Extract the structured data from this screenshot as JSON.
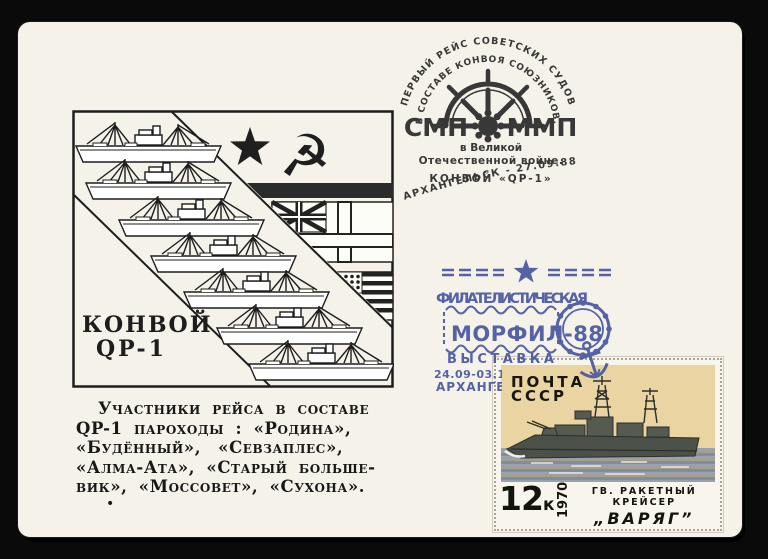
{
  "colors": {
    "background": "#0a0a0a",
    "paper": "#f5f2e9",
    "ink_black": "#2b2b2b",
    "ink_blue": "#44549f",
    "stamp_cream": "#e9d4a2",
    "stamp_sea": "#97a0ab",
    "warship_grey": "#4b5049"
  },
  "cachet": {
    "box_label_line1": "КОНВОЙ",
    "box_label_line2": "QP-1"
  },
  "note": {
    "lines": [
      "Участники рейса в составе",
      "QP-1 пароходы : «Родина»,",
      "«Будённый», «Севзаплес»,",
      "«Алма-Ата», «Старый больше-",
      "вик», «Моссовет», «Сухона»."
    ],
    "bullet": "•"
  },
  "postmark_voyage": {
    "arc_outer": "ПЕРВЫЙ РЕЙС СОВЕТСКИХ СУДОВ",
    "arc_inner": "В СОСТАВЕ КОНВОЯ СОЮЗНИКОВ.",
    "abbr_left": "СМП",
    "abbr_right": "ММП",
    "line1": "в Великой",
    "line2": "Отечественной войне.",
    "line3": "КОНВОЙ «QP-1»",
    "arc_bottom": "АРХАНГЕЛЬСК - 27.09.88"
  },
  "postmark_exhibition": {
    "line1": "ФИЛАТЕЛИСТИЧЕСКАЯ",
    "title": "МОРФИЛ-88",
    "line2": "ВЫСТАВКА",
    "line3": "24.09-03.10.1988",
    "line4": "АРХАНГЕЛЬСК"
  },
  "stamp": {
    "postal": "ПОЧТА",
    "country": "СССР",
    "denomination": "12",
    "denomination_unit": "к",
    "year": "1970",
    "caption_line1": "ГВ. РАКЕТНЫЙ КРЕЙСЕР",
    "caption_line2": "„ВАРЯГ”"
  }
}
